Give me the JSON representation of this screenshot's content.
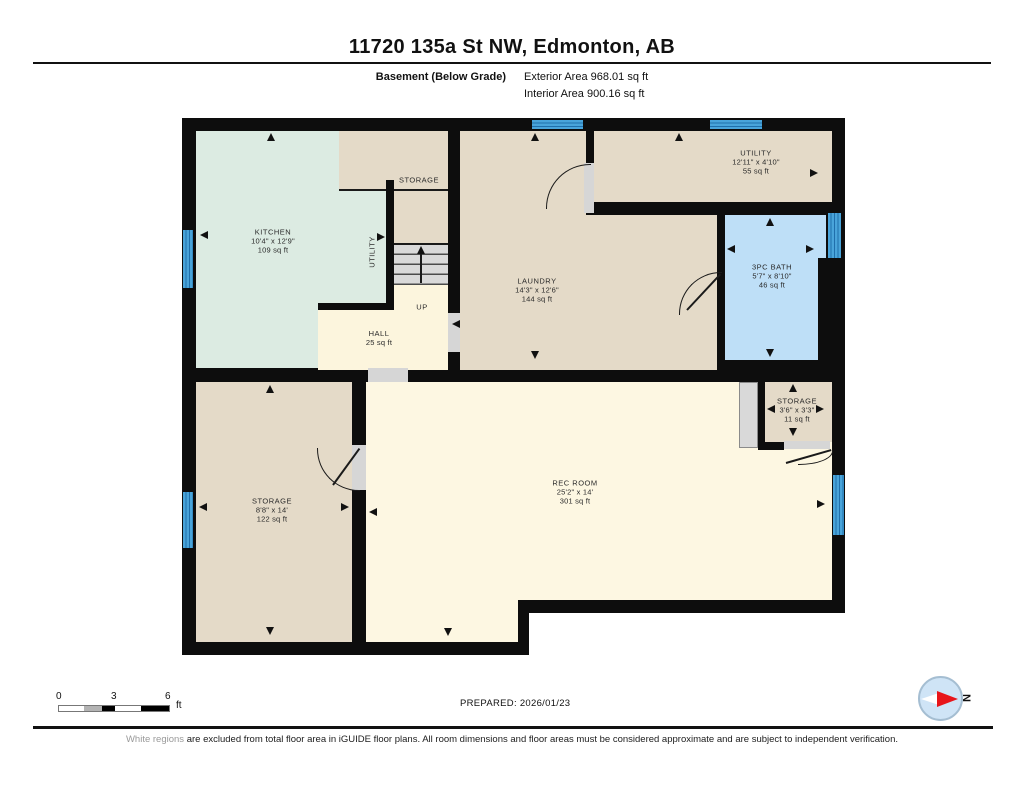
{
  "header": {
    "title": "11720 135a St NW, Edmonton, AB",
    "floor_label": "Basement (Below Grade)",
    "exterior_area": "Exterior Area 968.01 sq ft",
    "interior_area": "Interior Area 900.16 sq ft"
  },
  "rooms": {
    "kitchen": {
      "name": "KITCHEN",
      "dims": "10'4\" x 12'9\"",
      "area": "109 sq ft"
    },
    "storage_top": {
      "name": "STORAGE"
    },
    "utility_closet": {
      "name": "UTILITY"
    },
    "hall": {
      "name": "HALL",
      "area": "25 sq ft"
    },
    "laundry": {
      "name": "LAUNDRY",
      "dims": "14'3\" x 12'6\"",
      "area": "144 sq ft"
    },
    "utility": {
      "name": "UTILITY",
      "dims": "12'11\" x 4'10\"",
      "area": "55 sq ft"
    },
    "bath": {
      "name": "3PC BATH",
      "dims": "5'7\" x 8'10\"",
      "area": "46 sq ft"
    },
    "storage_small": {
      "name": "STORAGE",
      "dims": "3'6\" x 3'3\"",
      "area": "11 sq ft"
    },
    "storage_main": {
      "name": "STORAGE",
      "dims": "8'8\" x 14'",
      "area": "122 sq ft"
    },
    "rec_room": {
      "name": "REC ROOM",
      "dims": "25'2\" x 14'",
      "area": "301 sq ft"
    }
  },
  "stairs": {
    "label": "UP"
  },
  "footer": {
    "scale": {
      "ticks": [
        "0",
        "3",
        "6"
      ],
      "unit": "ft"
    },
    "prepared": "PREPARED: 2026/01/23",
    "compass_n": "N",
    "disclaimer_gray": "White regions",
    "disclaimer_rest": " are excluded from total floor area in iGUIDE floor plans. All room dimensions and floor areas must be considered approximate and are subject to independent verification."
  },
  "colors": {
    "wall": "#0d0d0d",
    "kitchen_fill": "#dcebe2",
    "storage_fill": "#e4dac8",
    "hall_rec_fill": "#fcf5dd",
    "bath_fill": "#bedff7",
    "window_blue": "#49a4da",
    "compass_needle": "#e8151a"
  }
}
